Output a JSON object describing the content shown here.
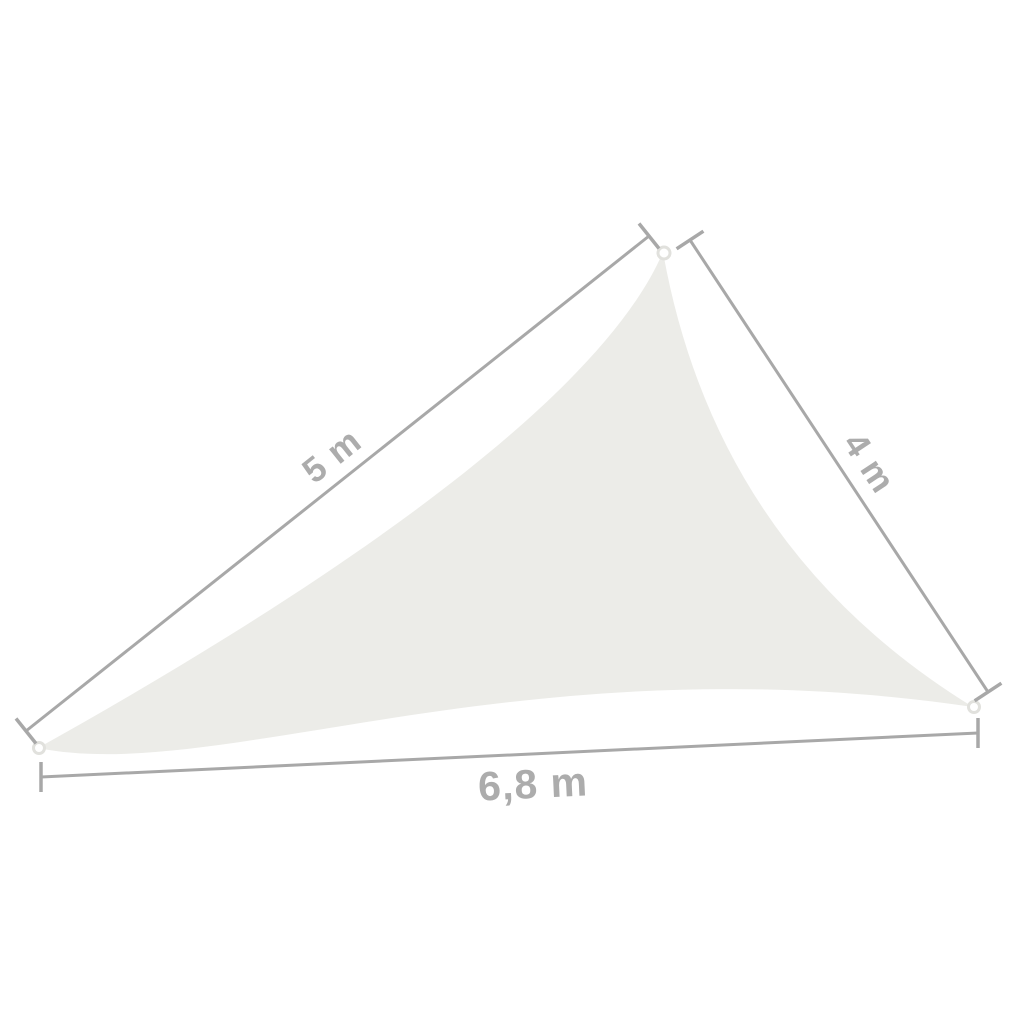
{
  "labels": {
    "side_left": "5 m",
    "side_right": "4 m",
    "side_bottom": "6,8 m"
  },
  "colors": {
    "background": "#FFFFFF",
    "sail_fill": "#ECECE8",
    "dimension_line": "#A8A8A8",
    "label_text": "#ACACAC",
    "grommet_ring": "#E1E1DD",
    "grommet_fill": "#FFFFFF"
  }
}
